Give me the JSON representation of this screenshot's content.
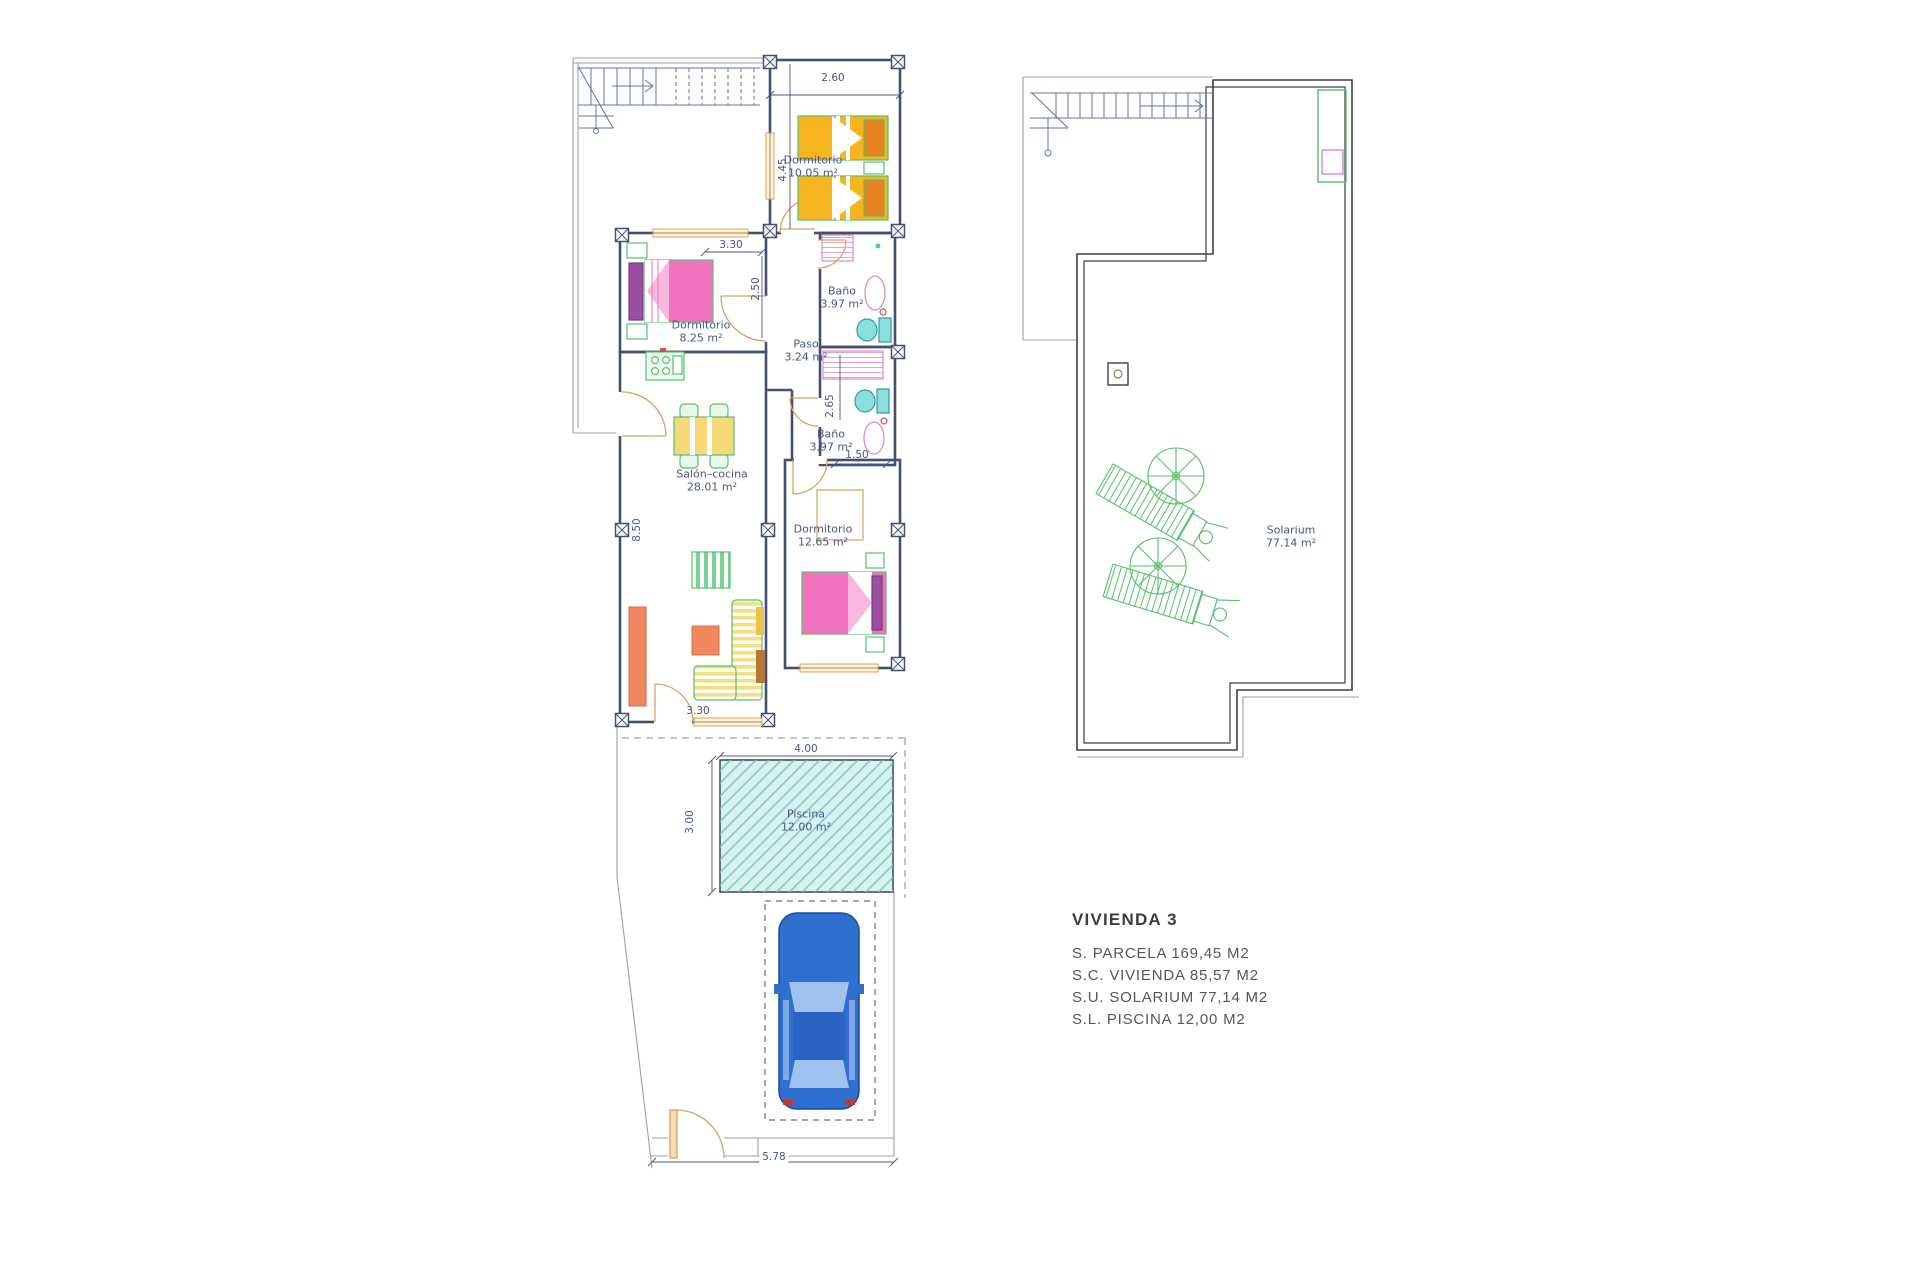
{
  "ground_floor": {
    "rooms": [
      {
        "name": "Dormitorio",
        "area": "10.05 m²"
      },
      {
        "name": "Baño",
        "area": "3.97 m²"
      },
      {
        "name": "Dormitorio",
        "area": "8.25 m²"
      },
      {
        "name": "Paso",
        "area": "3.24 m²"
      },
      {
        "name": "Baño",
        "area": "3.97 m²"
      },
      {
        "name": "Salón–cocina",
        "area": "28.01 m²"
      },
      {
        "name": "Dormitorio",
        "area": "12.65 m²"
      },
      {
        "name": "Piscina",
        "area": "12.00 m²"
      }
    ],
    "dimensions": {
      "bedroom1_width": "2.60",
      "bedroom1_height": "4.45",
      "bedroom2_width": "3.30",
      "bedroom2_height": "2.50",
      "salon_height": "8.50",
      "bath2_height": "2.65",
      "bath2_width": "1.50",
      "salon_width": "3.30",
      "pool_width": "4.00",
      "pool_height": "3.00",
      "plot_front_width": "5.78"
    }
  },
  "solarium_floor": {
    "room": {
      "name": "Solarium",
      "area": "77.14 m²"
    }
  },
  "title_block": {
    "title": "VIVIENDA 3",
    "lines": [
      "S. PARCELA 169,45 M2",
      "S.C. VIVIENDA 85,57 M2",
      "S.U. SOLARIUM 77,14 M2",
      "S.L. PISCINA 12,00 M2"
    ]
  },
  "colors": {
    "wall": "#454f73",
    "wall_solarium": "#3e3e48",
    "boundary": "#98a0ae",
    "dimension_text": "#4a5588",
    "furniture_green": "#57c06a",
    "bed_yellow": "#f6b41f",
    "bed_orange_pillow": "#e8831f",
    "bed_pink": "#f272bd",
    "wardrobe_purple": "#9b4fa0",
    "door_tan": "#d8a35c",
    "sofa_yellow": "#f5e07e",
    "furniture_orange": "#f0875f",
    "pool_teal": "#6cc6c0",
    "car_blue": "#2f6fd0",
    "fixture_pink": "#e08ac0",
    "toilet_cyan": "#8adfdc",
    "stair_blue": "#6470b0",
    "title_text": "#3d3d3d"
  }
}
